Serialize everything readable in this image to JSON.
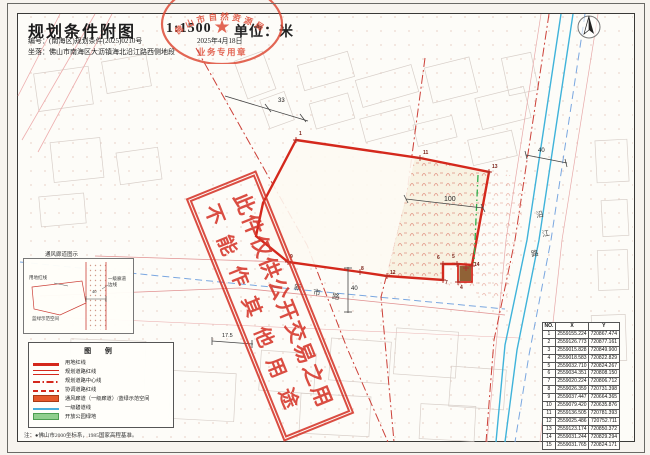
{
  "header": {
    "title": "规划条件附图",
    "scale": "1:1500",
    "unit": "单位：米",
    "doc_number": "编号：(南海区)规划条件(2025)0210号",
    "date": "2025年4月18日",
    "location": "坐落：佛山市南海区大沥镇海北沿江路西侧地段"
  },
  "seal": {
    "arc_text": "佛山市自然资源局",
    "star": "★",
    "bottom_text": "业务专用章"
  },
  "watermark": {
    "line1": "此件仅供公开交易之用",
    "line2": "不能作其他用途"
  },
  "map": {
    "road_yanjiang": [
      "沿",
      "江",
      "路"
    ],
    "road_xinshi": [
      "新",
      "市",
      "路"
    ],
    "dims": {
      "d33": "33",
      "d100": "100",
      "d40_xinshi": "40",
      "d40_yanjiang": "40",
      "d17_5": "17.5"
    },
    "vertices": [
      "1",
      "11",
      "13",
      "14",
      "5",
      "6",
      "7",
      "4",
      "12",
      "8",
      "9"
    ]
  },
  "inset": {
    "title": "通风廊道图示",
    "label_left": "用地红线",
    "label_right1": "一级廊道",
    "label_right2": "边线",
    "label_bottom": "蓝绿示范空间",
    "dim": "40"
  },
  "legend": {
    "title": "图 例",
    "items": [
      {
        "label": "用地红线",
        "type": "sw-red-thick"
      },
      {
        "label": "规划道路红线",
        "type": "sw-red-double"
      },
      {
        "label": "规划道路中心线",
        "type": "sw-red-dashdot"
      },
      {
        "label": "协调道路红线",
        "type": "sw-red-dashed"
      },
      {
        "label": "通风廊道（一级廊道）/蓝绿示范空间",
        "type": "sw-orange-fill"
      },
      {
        "label": "一级碧道线",
        "type": "sw-blue-line"
      },
      {
        "label": "开放公园绿地",
        "type": "sw-green-fill"
      }
    ]
  },
  "note": "注：●佛山市2000坐标系，1985国家高程基准。",
  "table": {
    "headers": [
      "NO.",
      "X",
      "Y"
    ],
    "rows": [
      [
        "1",
        "2559155.224",
        "720867.474"
      ],
      [
        "2",
        "2559126.773",
        "720877.161"
      ],
      [
        "3",
        "2559015.828",
        "720849.900"
      ],
      [
        "4",
        "2559018.583",
        "720822.829"
      ],
      [
        "5",
        "2559032.710",
        "720824.267"
      ],
      [
        "6",
        "2559034.351",
        "720808.150"
      ],
      [
        "7",
        "2559020.224",
        "720806.712"
      ],
      [
        "8",
        "2559026.359",
        "720731.398"
      ],
      [
        "9",
        "2559037.447",
        "720664.365"
      ],
      [
        "10",
        "2559079.420",
        "720635.876"
      ],
      [
        "11",
        "2559136.505",
        "720781.393"
      ],
      [
        "12",
        "2559025.486",
        "720752.711"
      ],
      [
        "13",
        "2559123.174",
        "720850.372"
      ],
      [
        "14",
        "2559031.244",
        "720829.294"
      ],
      [
        "15",
        "2559031.765",
        "720824.171"
      ]
    ]
  },
  "colors": {
    "parcel_red": "#d4281c",
    "seal_red": "#dd4631",
    "cyan_river": "#3fb3da",
    "green_corridor": "#2fae4a",
    "blue_dash": "#7aa7e0"
  }
}
